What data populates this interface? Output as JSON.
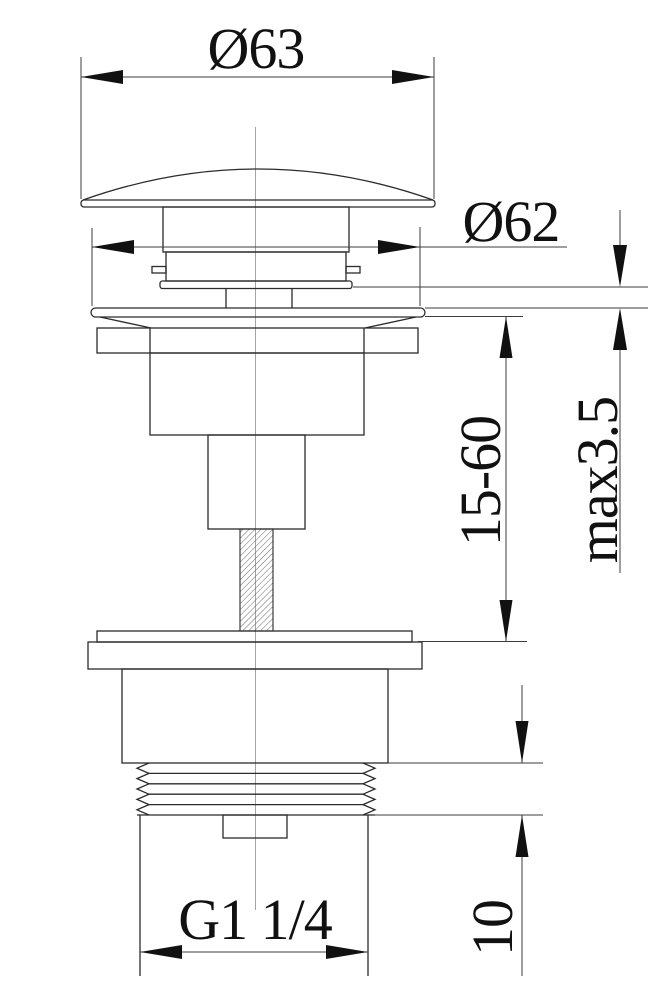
{
  "drawing": {
    "background_color": "#ffffff",
    "outline_color": "#2b2b2b",
    "dimension_line_color": "#3c3c3c",
    "centerline_color": "#9a9a9a",
    "text_color": "#111111",
    "dimension_labels": {
      "cap_diameter": "Ø63",
      "flange_diameter": "Ø62",
      "clamping_height_range": "15-60",
      "max_deck_thickness": "max3.5",
      "thread_length": "10",
      "thread_size": "G1 1/4"
    }
  }
}
